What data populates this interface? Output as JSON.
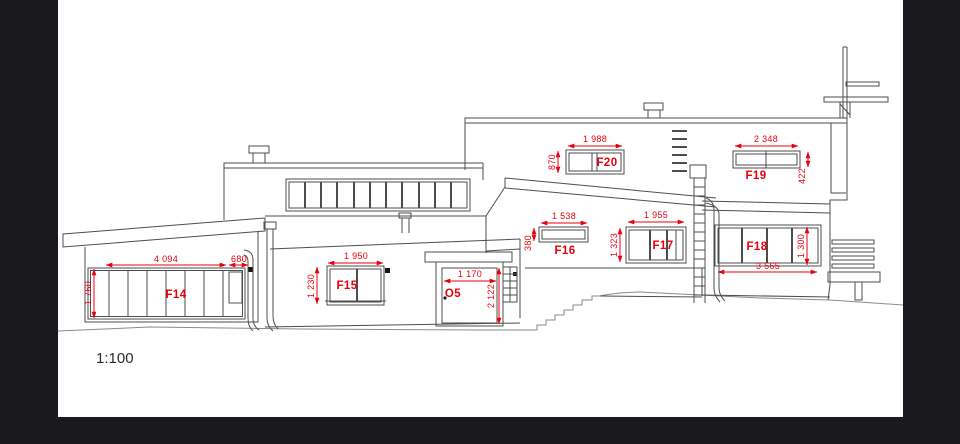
{
  "drawing_type": "house-elevation",
  "scale_label": "1:100",
  "annotation_color": "#e8000d",
  "sheet_color": "#ffffff",
  "background_color": "#1a1a1e",
  "windows": {
    "f14": {
      "label": "F14",
      "width": "4 094",
      "width_side": "680",
      "height": "1 760"
    },
    "f15": {
      "label": "F15",
      "width": "1 950",
      "height": "1 230"
    },
    "o5": {
      "label": "O5",
      "width": "1 170",
      "height": "2 122"
    },
    "f16": {
      "label": "F16",
      "width": "1 538",
      "height": "380"
    },
    "f17": {
      "label": "F17",
      "width": "1 955",
      "height": "1 323"
    },
    "f18": {
      "label": "F18",
      "width": "3 565",
      "height": "1 300"
    },
    "f19": {
      "label": "F19",
      "width": "2 348",
      "height": "422"
    },
    "f20": {
      "label": "F20",
      "width": "1 988",
      "height": "870"
    }
  }
}
